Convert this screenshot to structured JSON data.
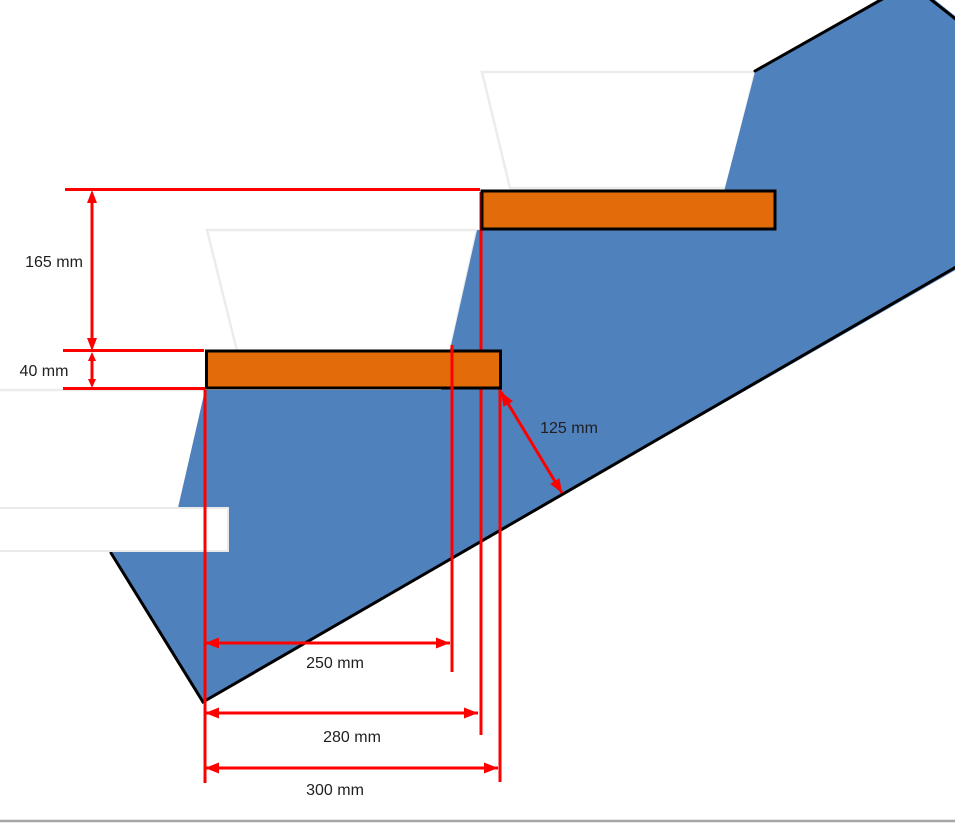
{
  "diagram": {
    "type": "stair-step-cross-section",
    "dimensions": {
      "rise": "165 mm",
      "tread_thickness": "40 mm",
      "going": "250 mm",
      "run_to_upper_tread": "280 mm",
      "tread_depth": "300 mm",
      "perpendicular_depth": "125 mm"
    },
    "colors": {
      "stringer_fill": "#4f81bd",
      "tread_fill": "#e36c0a",
      "outline": "#000000",
      "dimension_red": "#ff0000",
      "ghost_outline": "#ececec",
      "ghost_tread_border": "#e9e9e9",
      "baseline_gray": "#a6a6a6"
    }
  }
}
